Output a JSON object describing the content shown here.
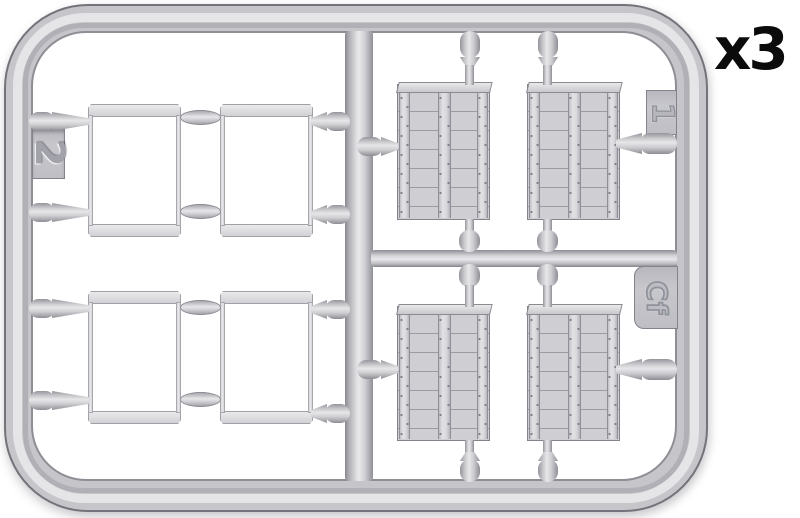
{
  "diagram": {
    "quantity_label": "x3",
    "tabs": {
      "sprue_number": "2",
      "part_number": "1",
      "sprue_letter": "Cf"
    },
    "colors": {
      "background": "#ffffff",
      "plastic": "#c6c6ca",
      "plastic_highlight": "#ececee",
      "plastic_shadow": "#8b8b92",
      "outline": "#73737b",
      "label_text": "#0b0b0b"
    },
    "parts": {
      "open_frame_panels": 4,
      "planked_panels": 4
    }
  }
}
